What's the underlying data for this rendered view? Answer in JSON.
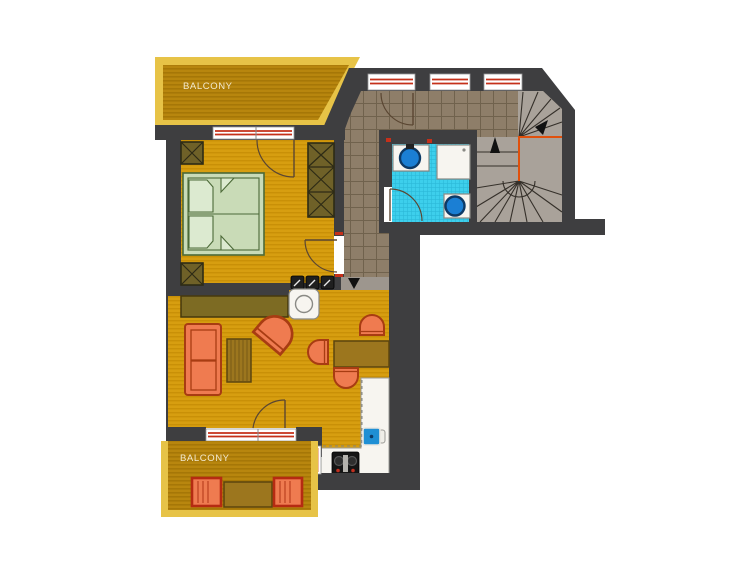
{
  "labels": {
    "balcony_top": "BALCONY",
    "balcony_bottom": "BALCONY"
  },
  "colors": {
    "wall": "#3E3E40",
    "floor": "#D79E10",
    "floor_stripe": "#C99007",
    "balcony_floor": "#B8860E",
    "balcony_stripe": "#A67707",
    "balcony_border": "#E7C347",
    "tile": "#8E7E69",
    "tile_line": "#70624D",
    "bath": "#3DCFEC",
    "bath_line": "#2BB9D8",
    "stair": "#A9A29A",
    "stair_line": "#35302A",
    "step": "#9D968E",
    "accent_red": "#C5301A",
    "accent_orange": "#E0500C",
    "door_arc": "#5A4632",
    "furn": "#EF7B50",
    "furn_border": "#A83C12",
    "wood": "#9C761E",
    "wood_dark": "#5C450E",
    "counter_olive": "#7D6B23",
    "counter_olive_dark": "#46390D",
    "wardrobe": "#6F6128",
    "wardrobe_line": "#2E2B15",
    "bed": "#C9DBB7",
    "bed_border": "#4C6A38",
    "pillow": "#DCEAD0",
    "water_blue": "#1B7FD4",
    "water_ring": "#0D3A66",
    "fixture": "#F7F5F0",
    "fixture_border": "#8A8A85",
    "stove": "#151515",
    "arrow": "#111111",
    "label": "#F2E9CF"
  }
}
